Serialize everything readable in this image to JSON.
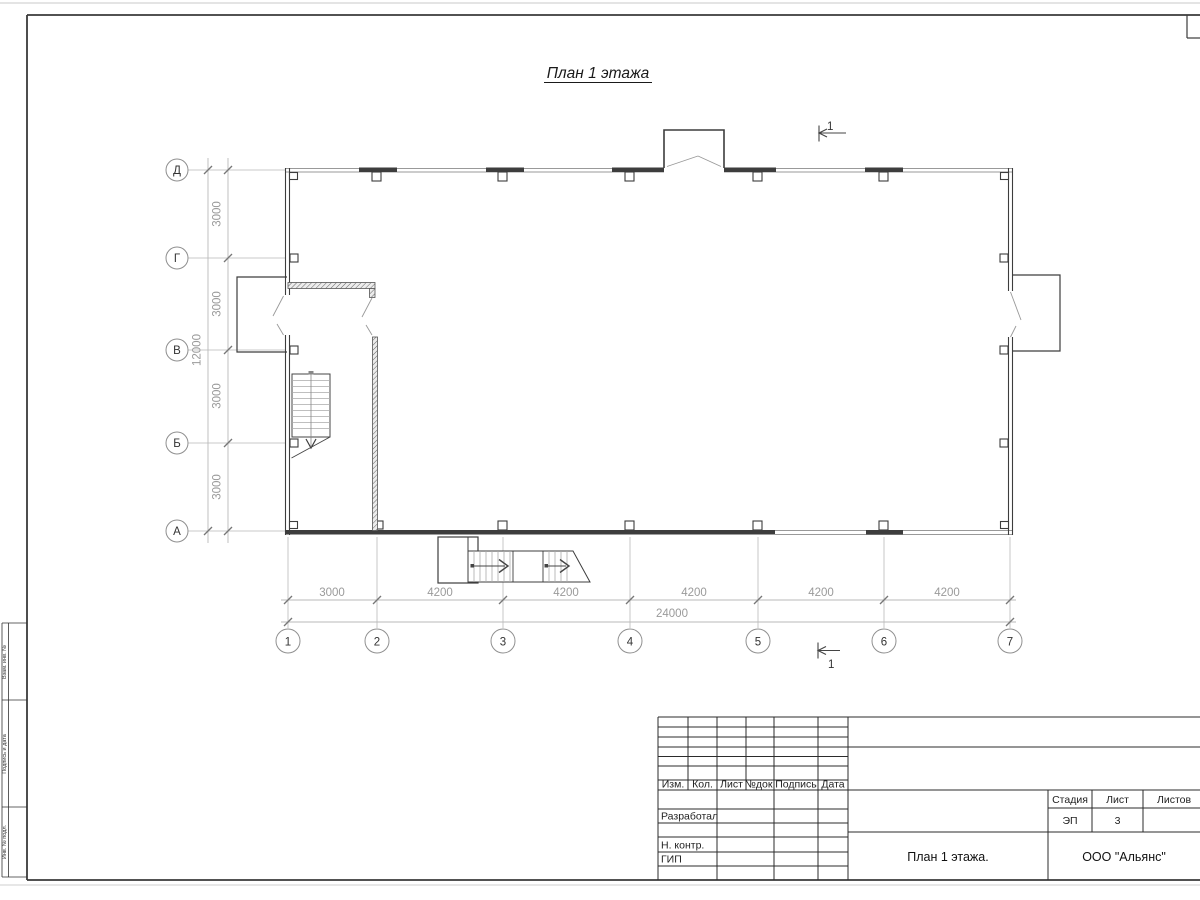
{
  "title": "План 1 этажа",
  "axes": {
    "rows": [
      "Д",
      "Г",
      "В",
      "Б",
      "А"
    ],
    "cols": [
      "1",
      "2",
      "3",
      "4",
      "5",
      "6",
      "7"
    ]
  },
  "dims": {
    "v": [
      "3000",
      "3000",
      "3000",
      "3000"
    ],
    "v_total": "12000",
    "h": [
      "3000",
      "4200",
      "4200",
      "4200",
      "4200",
      "4200"
    ],
    "h_total": "24000"
  },
  "section": {
    "label": "1"
  },
  "margin": {
    "cells": [
      "Взам. инв. №",
      "Подпись и дата",
      "Инв. № подл."
    ]
  },
  "tb": {
    "header": [
      "Изм.",
      "Кол.",
      "Лист",
      "№док.",
      "Подпись",
      "Дата"
    ],
    "roles": [
      "Разработал",
      "Н. контр.",
      "ГИП"
    ],
    "stage_label": "Стадия",
    "sheet_label": "Лист",
    "sheets_label": "Листов",
    "stage_value": "ЭП",
    "sheet_value": "3",
    "drawing_name": "План 1 этажа.",
    "company": "ООО \"Альянс\""
  }
}
